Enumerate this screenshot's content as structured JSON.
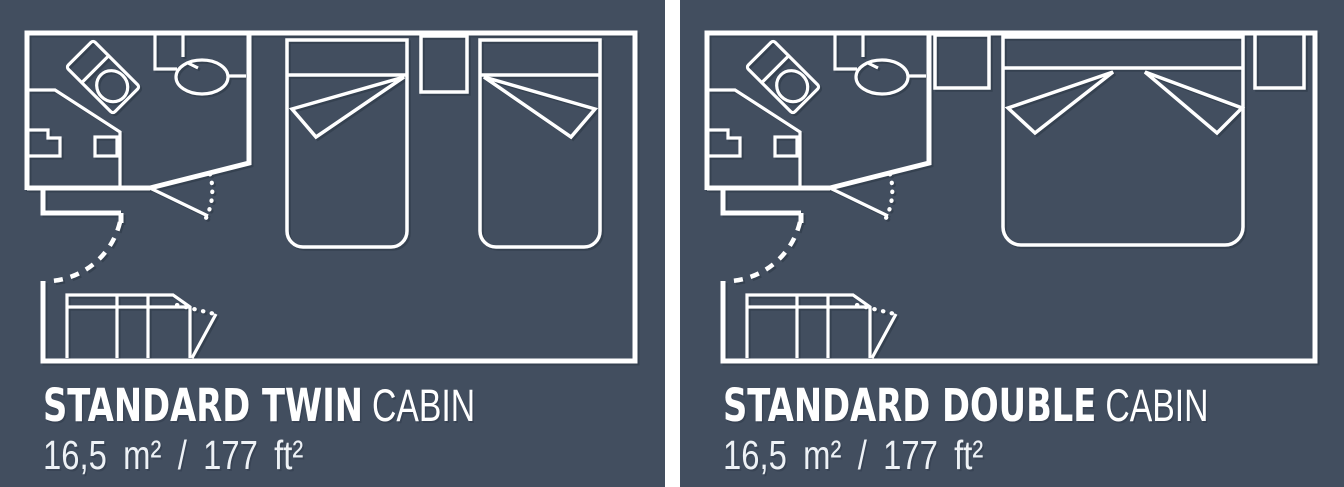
{
  "colors": {
    "panel_background": "#424e5f",
    "divider": "#ffffff",
    "linework": "#ffffff",
    "title_text": "#ffffff",
    "area_text": "#eef2f6"
  },
  "panels": [
    {
      "id": "standard-twin",
      "title_bold": "STANDARD TWIN",
      "title_light": "CABIN",
      "area": "16,5 m² / 177 ft²",
      "bed_config": "two single beds"
    },
    {
      "id": "standard-double",
      "title_bold": "STANDARD DOUBLE",
      "title_light": "CABIN",
      "area": "16,5 m² / 177 ft²",
      "bed_config": "one double bed"
    }
  ]
}
